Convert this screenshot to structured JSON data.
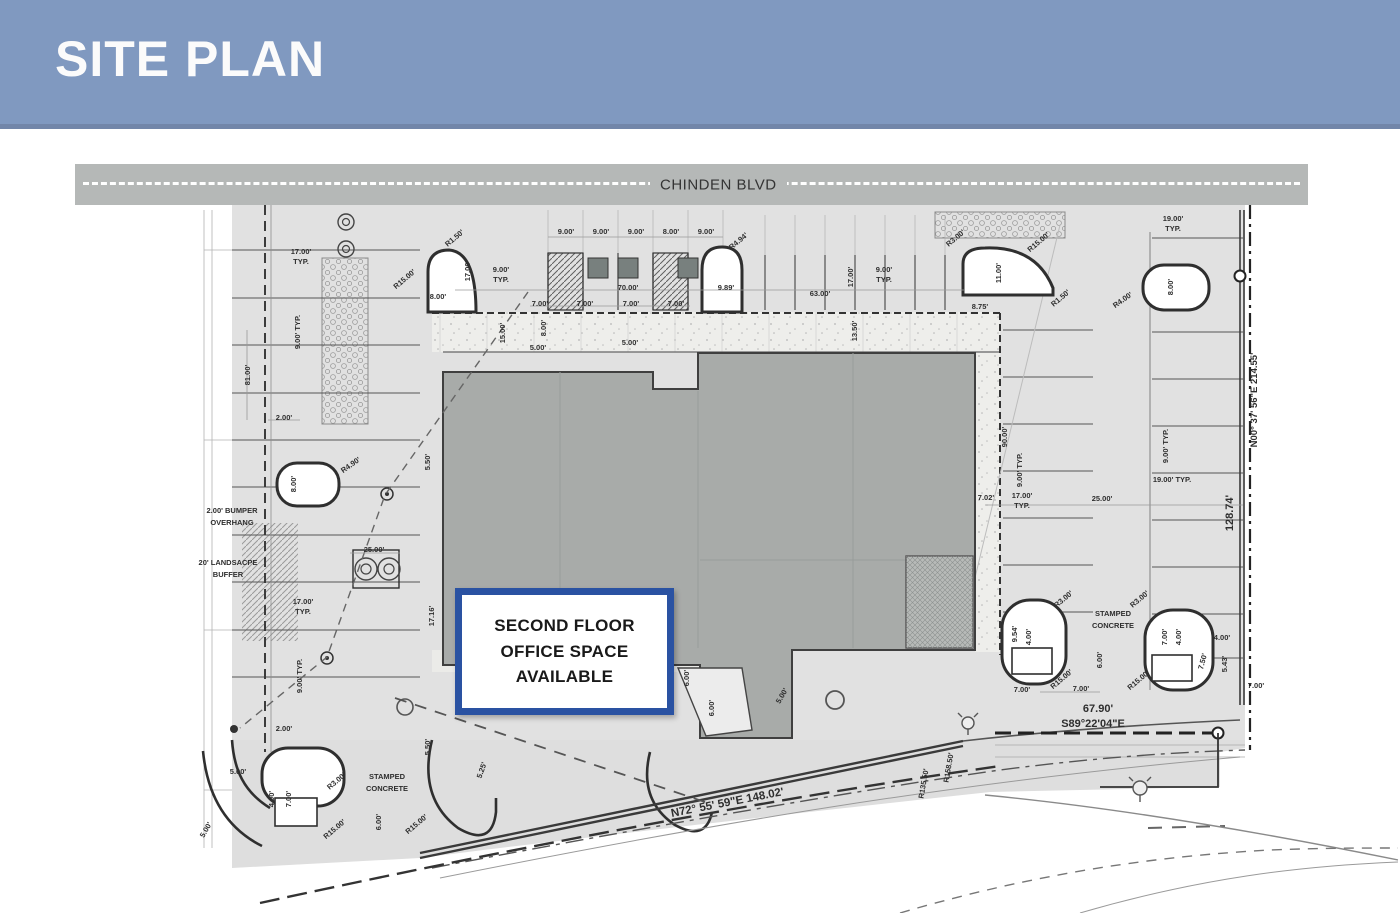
{
  "header": {
    "title": "SITE PLAN"
  },
  "road": {
    "name": "CHINDEN BLVD"
  },
  "callout": {
    "text": "SECOND FLOOR\nOFFICE SPACE\nAVAILABLE"
  },
  "colors": {
    "header_bg": "#8099c0",
    "road_bg": "#b5b8b7",
    "paving": "#e1e1e1",
    "building": "#a8aba9",
    "callout_border": "#2a52a2",
    "ink": "#2e2e2e"
  },
  "plan": {
    "boundary_bearings": {
      "east": "N00° 37' 56\"E  214.55'",
      "east_segment": "128.74'",
      "south": "N72° 55' 59\"E  148.02'",
      "south_east": "S89°22'04\"E",
      "south_east_length": "67.90'"
    },
    "labels": [
      {
        "t": "17.00'",
        "x": 301,
        "y": 254
      },
      {
        "t": "TYP.",
        "x": 301,
        "y": 264
      },
      {
        "t": "9.00' TYP.",
        "x": 300,
        "y": 332,
        "r": -90
      },
      {
        "t": "81.00'",
        "x": 250,
        "y": 375,
        "r": -90
      },
      {
        "t": "2.00'",
        "x": 284,
        "y": 420
      },
      {
        "t": "25.00'",
        "x": 374,
        "y": 552
      },
      {
        "t": "17.00'",
        "x": 303,
        "y": 604
      },
      {
        "t": "TYP.",
        "x": 303,
        "y": 614
      },
      {
        "t": "9.00' TYP.",
        "x": 302,
        "y": 676,
        "r": -90
      },
      {
        "t": "8.00'",
        "x": 296,
        "y": 484,
        "r": -90
      },
      {
        "t": "R4.90'",
        "x": 352,
        "y": 467,
        "r": -35
      },
      {
        "t": "2.00' BUMPER",
        "x": 232,
        "y": 513
      },
      {
        "t": "OVERHANG",
        "x": 232,
        "y": 525
      },
      {
        "t": "20' LANDSACPE",
        "x": 228,
        "y": 565
      },
      {
        "t": "BUFFER",
        "x": 228,
        "y": 577
      },
      {
        "t": "2.00'",
        "x": 284,
        "y": 731
      },
      {
        "t": "5.00'",
        "x": 238,
        "y": 774
      },
      {
        "t": "4.00'",
        "x": 274,
        "y": 799,
        "r": -90
      },
      {
        "t": "7.00'",
        "x": 291,
        "y": 799,
        "r": -90
      },
      {
        "t": "5.00'",
        "x": 208,
        "y": 831,
        "r": -60
      },
      {
        "t": "R3.00'",
        "x": 338,
        "y": 783,
        "r": -40
      },
      {
        "t": "R15.00'",
        "x": 336,
        "y": 831,
        "r": -40
      },
      {
        "t": "R15.00'",
        "x": 418,
        "y": 826,
        "r": -40
      },
      {
        "t": "STAMPED",
        "x": 387,
        "y": 779
      },
      {
        "t": "CONCRETE",
        "x": 387,
        "y": 791
      },
      {
        "t": "6.00'",
        "x": 381,
        "y": 822,
        "r": -90
      },
      {
        "t": "R15.00'",
        "x": 406,
        "y": 281,
        "r": -40
      },
      {
        "t": "R1.50'",
        "x": 456,
        "y": 240,
        "r": -40
      },
      {
        "t": "8.00'",
        "x": 438,
        "y": 299
      },
      {
        "t": "17.00'",
        "x": 470,
        "y": 271,
        "r": -90
      },
      {
        "t": "9.00'",
        "x": 501,
        "y": 272
      },
      {
        "t": "TYP.",
        "x": 501,
        "y": 282
      },
      {
        "t": "9.00'",
        "x": 566,
        "y": 234
      },
      {
        "t": "9.00'",
        "x": 601,
        "y": 234
      },
      {
        "t": "9.00'",
        "x": 636,
        "y": 234
      },
      {
        "t": "8.00'",
        "x": 671,
        "y": 234
      },
      {
        "t": "9.00'",
        "x": 706,
        "y": 234
      },
      {
        "t": "R4.94'",
        "x": 740,
        "y": 243,
        "r": -40
      },
      {
        "t": "70.00'",
        "x": 628,
        "y": 290
      },
      {
        "t": "9.89'",
        "x": 726,
        "y": 290
      },
      {
        "t": "63.00'",
        "x": 820,
        "y": 296
      },
      {
        "t": "7.00'",
        "x": 540,
        "y": 306
      },
      {
        "t": "7.00'",
        "x": 585,
        "y": 306
      },
      {
        "t": "7.00'",
        "x": 631,
        "y": 306
      },
      {
        "t": "7.00'",
        "x": 676,
        "y": 306
      },
      {
        "t": "15.00'",
        "x": 505,
        "y": 333,
        "r": -90
      },
      {
        "t": "8.00'",
        "x": 546,
        "y": 328,
        "r": -90
      },
      {
        "t": "5.00'",
        "x": 538,
        "y": 350
      },
      {
        "t": "5.00'",
        "x": 630,
        "y": 345
      },
      {
        "t": "17.00'",
        "x": 853,
        "y": 277,
        "r": -90
      },
      {
        "t": "9.00'",
        "x": 884,
        "y": 272
      },
      {
        "t": "TYP.",
        "x": 884,
        "y": 282
      },
      {
        "t": "13.50'",
        "x": 857,
        "y": 331,
        "r": -90
      },
      {
        "t": "8.75'",
        "x": 980,
        "y": 309
      },
      {
        "t": "R3.00'",
        "x": 957,
        "y": 240,
        "r": -40
      },
      {
        "t": "R15.00'",
        "x": 1040,
        "y": 244,
        "r": -40
      },
      {
        "t": "R1.50'",
        "x": 1062,
        "y": 300,
        "r": -40
      },
      {
        "t": "11.00'",
        "x": 1001,
        "y": 273,
        "r": -90
      },
      {
        "t": "19.00'",
        "x": 1173,
        "y": 221
      },
      {
        "t": "TYP.",
        "x": 1173,
        "y": 231
      },
      {
        "t": "8.00'",
        "x": 1173,
        "y": 287,
        "r": -90
      },
      {
        "t": "R4.00'",
        "x": 1124,
        "y": 302,
        "r": -35
      },
      {
        "t": "90.00'",
        "x": 1007,
        "y": 437,
        "r": -90
      },
      {
        "t": "9.00' TYP.",
        "x": 1022,
        "y": 470,
        "r": -90
      },
      {
        "t": "17.00'",
        "x": 1022,
        "y": 498
      },
      {
        "t": "TYP.",
        "x": 1022,
        "y": 508
      },
      {
        "t": "7.02'",
        "x": 986,
        "y": 500
      },
      {
        "t": "25.00'",
        "x": 1102,
        "y": 501
      },
      {
        "t": "9.00' TYP.",
        "x": 1168,
        "y": 446,
        "r": -90
      },
      {
        "t": "19.00' TYP.",
        "x": 1172,
        "y": 482
      },
      {
        "t": "N00° 37' 56\"E  214.55'",
        "x": 1257,
        "y": 400,
        "r": -90,
        "s": 9.5,
        "w": "normal"
      },
      {
        "t": "128.74'",
        "x": 1233,
        "y": 513,
        "r": -90,
        "s": 11,
        "w": "normal"
      },
      {
        "t": "5.50'",
        "x": 430,
        "y": 462,
        "r": -90
      },
      {
        "t": "17.16'",
        "x": 434,
        "y": 616,
        "r": -90
      },
      {
        "t": "5.50'",
        "x": 430,
        "y": 747,
        "r": -90
      },
      {
        "t": "5.25'",
        "x": 484,
        "y": 771,
        "r": -70
      },
      {
        "t": "6.00'",
        "x": 689,
        "y": 678,
        "r": -90
      },
      {
        "t": "6.00'",
        "x": 714,
        "y": 708,
        "r": -90
      },
      {
        "t": "5.00'",
        "x": 784,
        "y": 697,
        "r": -60
      },
      {
        "t": "STAMPED",
        "x": 1113,
        "y": 616
      },
      {
        "t": "CONCRETE",
        "x": 1113,
        "y": 628
      },
      {
        "t": "R3.00'",
        "x": 1065,
        "y": 601,
        "r": -40
      },
      {
        "t": "R3.00'",
        "x": 1141,
        "y": 601,
        "r": -40
      },
      {
        "t": "R15.00'",
        "x": 1063,
        "y": 681,
        "r": -40
      },
      {
        "t": "R15.00'",
        "x": 1140,
        "y": 682,
        "r": -40
      },
      {
        "t": "9.54'",
        "x": 1017,
        "y": 634,
        "r": -90
      },
      {
        "t": "4.00'",
        "x": 1031,
        "y": 637,
        "r": -90
      },
      {
        "t": "6.00'",
        "x": 1102,
        "y": 660,
        "r": -90
      },
      {
        "t": "7.00'",
        "x": 1167,
        "y": 637,
        "r": -90
      },
      {
        "t": "4.00'",
        "x": 1181,
        "y": 637,
        "r": -90
      },
      {
        "t": "7.50'",
        "x": 1205,
        "y": 662,
        "r": -75
      },
      {
        "t": "4.00'",
        "x": 1222,
        "y": 640
      },
      {
        "t": "5.43'",
        "x": 1227,
        "y": 664,
        "r": -90
      },
      {
        "t": "7.00'",
        "x": 1022,
        "y": 692
      },
      {
        "t": "7.00'",
        "x": 1081,
        "y": 691
      },
      {
        "t": "7.00'",
        "x": 1256,
        "y": 688
      },
      {
        "t": "67.90'",
        "x": 1098,
        "y": 712,
        "s": 11,
        "w": "normal"
      },
      {
        "t": "S89°22'04\"E",
        "x": 1093,
        "y": 727,
        "s": 11,
        "w": "normal"
      },
      {
        "t": "N72° 55' 59\"E  148.02'",
        "x": 728,
        "y": 806,
        "r": -11,
        "s": 11.5,
        "w": "normal"
      },
      {
        "t": "R158.50'",
        "x": 951,
        "y": 768,
        "r": -80
      },
      {
        "t": "R135.50'",
        "x": 926,
        "y": 784,
        "r": -80
      }
    ]
  }
}
